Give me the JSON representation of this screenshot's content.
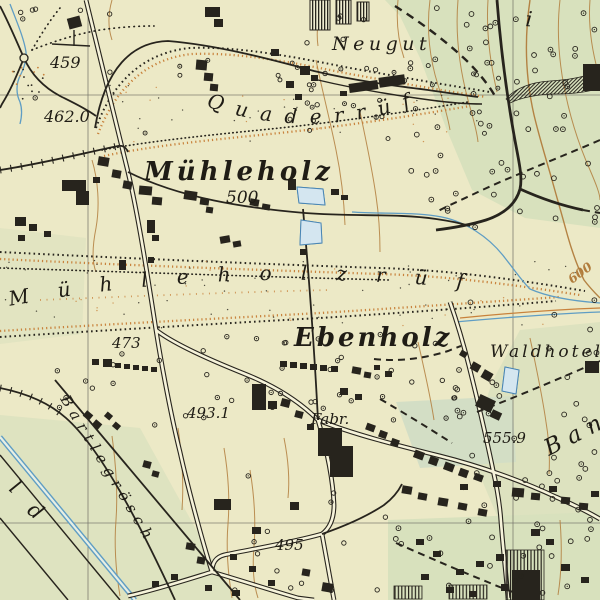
{
  "map": {
    "kind": "historic-topographic-map",
    "labels": {
      "neugut": "Neugut",
      "quaderruefe": "Quaderrüfe",
      "muehleholz": "Mühleholz",
      "muehleholzruefe": "Mühleholzrüfe",
      "ebenholz": "Ebenholz",
      "waldhotel": "Waldhotel",
      "fabrik": "Fabr.",
      "bartlegroesch": "Bartlegrösch",
      "ban": "Ban",
      "letter_l": "l",
      "letter_d": "d",
      "letter_i": "i",
      "elev_459": "459",
      "elev_462": "462.0",
      "elev_473": "473",
      "elev_493": "493.1",
      "elev_495": "495",
      "elev_500": "500",
      "elev_555": "555.9",
      "contour_600": "600"
    },
    "colors": {
      "paper": "#ece9c6",
      "forest_green": "#d5dfbc",
      "field_green": "#cfdcc6",
      "ink": "#27241d",
      "contour_brown": "#b17c3c",
      "debris_orange": "#c8823c",
      "water_blue": "#5f9dc4",
      "water_fill": "#d4e6f0",
      "water_line": "#4a86b4",
      "grid_gray": "#75736a",
      "road_fill": "#f6f3da",
      "label_ink": "#1f1c15"
    }
  }
}
